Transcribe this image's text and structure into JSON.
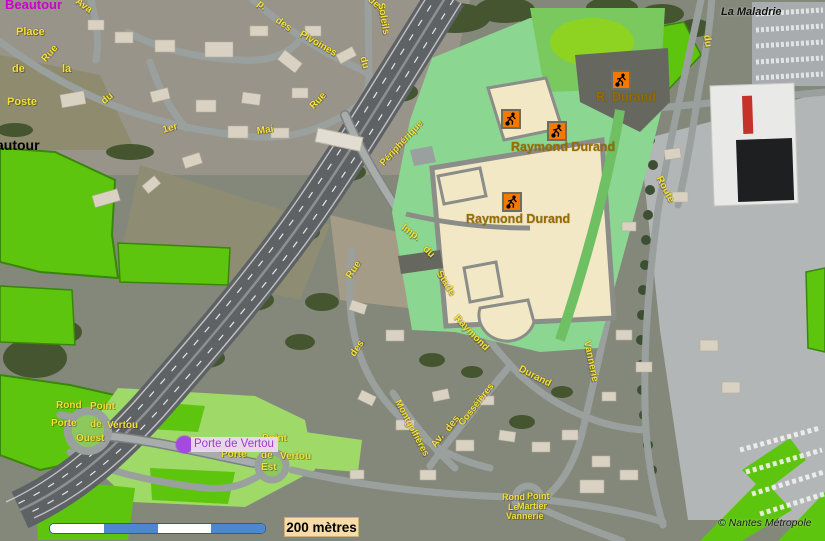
{
  "places": {
    "beautour": "Beautour",
    "place_line1": "Place",
    "place_de": "de",
    "place_la": "la",
    "place_line3": "Poste",
    "beautour_partial": "autour",
    "la_maladrie": "La Maladrie"
  },
  "facilities": {
    "site1_label": "R. Durand",
    "site2_label": "Raymond Durand",
    "site3_label": "Raymond Durand"
  },
  "poi": {
    "label": "Porte de Vertou"
  },
  "street_labels": [
    {
      "t": "Ava"
    },
    {
      "t": "Rue"
    },
    {
      "t": "du"
    },
    {
      "t": "1er"
    },
    {
      "t": "Mai"
    },
    {
      "t": "p."
    },
    {
      "t": "des"
    },
    {
      "t": "Pivoines"
    },
    {
      "t": "du"
    },
    {
      "t": "des"
    },
    {
      "t": "Soleils"
    },
    {
      "t": "Rue"
    },
    {
      "t": "Périphérique"
    },
    {
      "t": "Imp."
    },
    {
      "t": "du"
    },
    {
      "t": "Stade"
    },
    {
      "t": "Raymond"
    },
    {
      "t": "Durand"
    },
    {
      "t": "Rue"
    },
    {
      "t": "des"
    },
    {
      "t": "Montgolfières"
    },
    {
      "t": "Av."
    },
    {
      "t": "des"
    },
    {
      "t": "Cosséières"
    },
    {
      "t": "Vannerie"
    },
    {
      "t": "Route"
    },
    {
      "t": "du"
    },
    {
      "t": "Rond"
    },
    {
      "t": "Point"
    },
    {
      "t": "Porte"
    },
    {
      "t": "de"
    },
    {
      "t": "Vertou"
    },
    {
      "t": "Ouest"
    },
    {
      "t": "Point"
    },
    {
      "t": "Porte"
    },
    {
      "t": "de"
    },
    {
      "t": "Vertou"
    },
    {
      "t": "Est"
    },
    {
      "t": "Rond"
    },
    {
      "t": "Point"
    },
    {
      "t": "Le"
    },
    {
      "t": "Martier"
    },
    {
      "t": "Vannerie"
    }
  ],
  "scale": {
    "label": "200 mètres"
  },
  "attribution": "© Nantes Métropole",
  "colors": {
    "street_label_yellow": "#f4e23a",
    "facility_label_brown": "#996c00",
    "facility_icon_orange": "#f57900",
    "poi_purple": "#a44ae0",
    "park_green": "#5ec50f",
    "light_green": "#9fd968",
    "sports_field_cream": "#f2e8c6",
    "scale_blue": "#4f86d0",
    "beautour_magenta": "#cc00cc"
  }
}
